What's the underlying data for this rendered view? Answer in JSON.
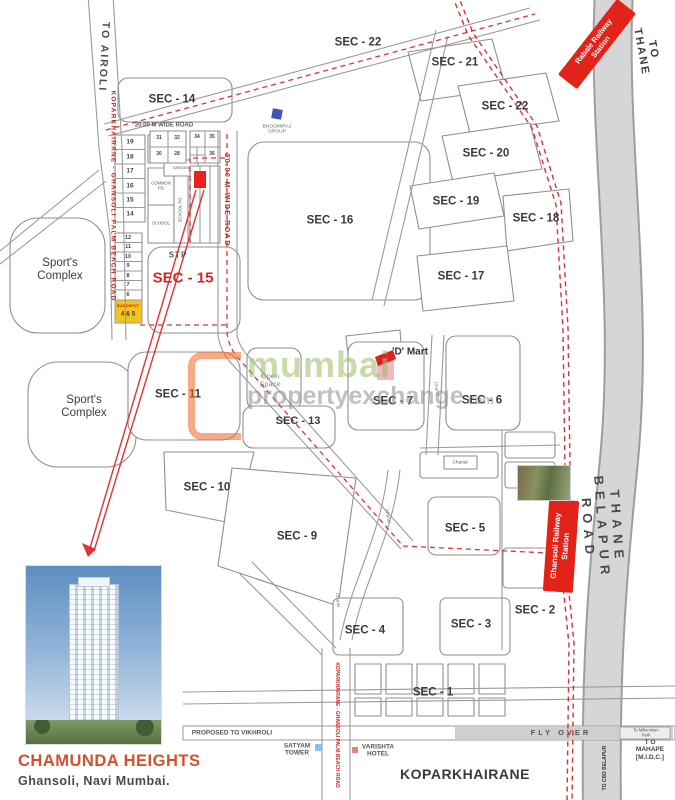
{
  "branding": {
    "project_name": "CHAMUNDA HEIGHTS",
    "project_location": "Ghansoli, Navi Mumbai."
  },
  "watermark": {
    "brand": "mumbai",
    "suffix": "propertyexchange",
    "tld": ".com"
  },
  "stations": {
    "rabale": "Rabale Railway\nStation",
    "ghansoli": "Ghansoli Railway\nStation"
  },
  "colors": {
    "station_red": "#e2231a",
    "route_dash_red": "#e03232",
    "road_label_red": "#cf1f1f",
    "sector_text": "#3a3a3a",
    "bus_depot_yellow": "#f2c51d",
    "watermark_green": "#9cbb66",
    "watermark_orange": "#f26522",
    "project_accent": "#d4502a",
    "bhoomiraj_blue": "#4053b8"
  },
  "map": {
    "labels": [
      {
        "id": "road-to-airoli",
        "text": "TO AIROLI",
        "x": 103,
        "y": 57,
        "rot": 93,
        "size": 10.5,
        "color": "#4a4a4a",
        "weight": 600,
        "ls": 2
      },
      {
        "id": "road-palm-beach-left",
        "text": "KOPARKHAIRANE - GHANSOLI PALM BEACH ROAD",
        "x": 113,
        "y": 196,
        "rot": 90,
        "size": 6.5,
        "color": "#cf1f1f",
        "ls": 1.2
      },
      {
        "id": "sector-14",
        "text": "SEC - 14",
        "x": 172,
        "y": 100
      },
      {
        "id": "road-20m-wide-top",
        "text": "20.00 M WIDE ROAD",
        "x": 164,
        "y": 126,
        "size": 6,
        "color": "#555",
        "weight": 600
      },
      {
        "id": "road-20m-wide-red",
        "text": "20.00 M WIDE ROAD",
        "x": 226,
        "y": 200,
        "rot": 90,
        "size": 7,
        "color": "#cf1f1f",
        "ls": 1.5
      },
      {
        "id": "sector-22-west",
        "text": "SEC - 22",
        "x": 358,
        "y": 43
      },
      {
        "id": "sector-21",
        "text": "SEC - 21",
        "x": 455,
        "y": 63
      },
      {
        "id": "sector-22-east",
        "text": "SEC - 22",
        "x": 505,
        "y": 107
      },
      {
        "id": "sector-20",
        "text": "SEC - 20",
        "x": 486,
        "y": 154
      },
      {
        "id": "sector-19",
        "text": "SEC - 19",
        "x": 456,
        "y": 202
      },
      {
        "id": "sector-18",
        "text": "SEC - 18",
        "x": 536,
        "y": 219
      },
      {
        "id": "sector-17",
        "text": "SEC - 17",
        "x": 461,
        "y": 277
      },
      {
        "id": "sector-16",
        "text": "SEC - 16",
        "x": 330,
        "y": 221
      },
      {
        "id": "sector-15",
        "text": "SEC - 15",
        "x": 183,
        "y": 279,
        "size": 15,
        "color": "#e01f1f"
      },
      {
        "id": "stp-label",
        "text": "STP",
        "x": 178,
        "y": 256,
        "size": 8,
        "color": "#555",
        "ls": 1
      },
      {
        "id": "sector-11",
        "text": "SEC - 11",
        "x": 178,
        "y": 395
      },
      {
        "id": "sector-13",
        "text": "SEC - 13",
        "x": 298,
        "y": 421,
        "size": 11
      },
      {
        "id": "sector-7",
        "text": "SEC - 7",
        "x": 393,
        "y": 402
      },
      {
        "id": "sector-6",
        "text": "SEC - 6",
        "x": 482,
        "y": 401
      },
      {
        "id": "sector-10",
        "text": "SEC - 10",
        "x": 207,
        "y": 488
      },
      {
        "id": "sector-9",
        "text": "SEC - 9",
        "x": 297,
        "y": 537
      },
      {
        "id": "sector-5",
        "text": "SEC - 5",
        "x": 465,
        "y": 529
      },
      {
        "id": "sector-4",
        "text": "SEC - 4",
        "x": 365,
        "y": 631
      },
      {
        "id": "sector-3",
        "text": "SEC - 3",
        "x": 471,
        "y": 625
      },
      {
        "id": "sector-2",
        "text": "SEC - 2",
        "x": 535,
        "y": 611
      },
      {
        "id": "sector-1",
        "text": "SEC - 1",
        "x": 433,
        "y": 693
      },
      {
        "id": "sports-complex-north",
        "text": "Sport's\nComplex",
        "x": 60,
        "y": 270,
        "size": 11.5,
        "weight": 400,
        "color": "#3d3d3d"
      },
      {
        "id": "sports-complex-south",
        "text": "Sport's\nComplex",
        "x": 84,
        "y": 407,
        "size": 11.5,
        "weight": 400,
        "color": "#3d3d3d"
      },
      {
        "id": "open-space-label",
        "text": "Open\nSpace",
        "x": 270,
        "y": 381,
        "size": 7.5,
        "weight": 400,
        "color": "#8a8a8a"
      },
      {
        "id": "dmart-label",
        "text": "'D' Mart",
        "x": 410,
        "y": 352,
        "size": 10,
        "weight": 600,
        "color": "#333"
      },
      {
        "id": "bhoomiraj-label",
        "text": "BHOOMIRAJ\nGROUP",
        "x": 277,
        "y": 130,
        "size": 4.8,
        "weight": 400,
        "color": "#666"
      },
      {
        "id": "road-to-thane",
        "text": "TO THANE",
        "x": 647,
        "y": 51,
        "rot": 80,
        "size": 11,
        "color": "#3f3f3f",
        "ls": 2
      },
      {
        "id": "road-thane-belapur",
        "text": "THANE BELAPUR ROAD",
        "x": 602,
        "y": 528,
        "rot": 86,
        "size": 13,
        "ls": 6,
        "color": "#4a4a4a"
      },
      {
        "id": "flyover-label",
        "text": "FLY OVER",
        "x": 561,
        "y": 733,
        "size": 7.5,
        "ls": 3,
        "color": "#555",
        "weight": 600
      },
      {
        "id": "road-proposed-vikhroli",
        "text": "PROPOSED TO VIKHROLI",
        "x": 232,
        "y": 733,
        "size": 6.5,
        "color": "#555",
        "weight": 600
      },
      {
        "id": "millennium-park-label",
        "text": "To Millennium Park",
        "x": 646,
        "y": 733,
        "size": 4.2,
        "weight": 400,
        "color": "#555"
      },
      {
        "id": "to-mahape-label",
        "text": "T O MAHAPE\n[M.I.D.C.]",
        "x": 650,
        "y": 750,
        "size": 6.5,
        "color": "#444",
        "weight": 600
      },
      {
        "id": "road-to-cbd-belapur",
        "text": "TO CBD BELAPUR",
        "x": 606,
        "y": 768,
        "rot": -90,
        "size": 5,
        "color": "#333",
        "weight": 600
      },
      {
        "id": "koparkhairane-label",
        "text": "KOPARKHAIRANE",
        "x": 465,
        "y": 775,
        "size": 14,
        "ls": 0.5
      },
      {
        "id": "road-palm-beach-bottom",
        "text": "KOPARKHAIRANE - GHANSOLI PALM BEACH ROAD",
        "x": 336,
        "y": 725,
        "rot": 90,
        "size": 5,
        "color": "#cf1f1f"
      },
      {
        "id": "satyam-tower-label",
        "text": "SATYAM\nTOWER",
        "x": 297,
        "y": 750,
        "size": 6.5,
        "color": "#555",
        "weight": 600
      },
      {
        "id": "varishta-hotel-label",
        "text": "VARISHTA\nHOTEL",
        "x": 378,
        "y": 751,
        "size": 6.5,
        "color": "#555",
        "weight": 600
      },
      {
        "id": "canal-label-1",
        "text": "Chanel",
        "x": 437,
        "y": 389,
        "rot": 80,
        "size": 4.5,
        "weight": 400,
        "color": "#777"
      },
      {
        "id": "canal-label-2",
        "text": "Chanel",
        "x": 388,
        "y": 516,
        "rot": 80,
        "size": 4.5,
        "weight": 400,
        "color": "#777"
      },
      {
        "id": "canal-label-3",
        "text": "Chanel",
        "x": 338,
        "y": 600,
        "rot": 85,
        "size": 4.5,
        "weight": 400,
        "color": "#777"
      },
      {
        "id": "canal-label-4",
        "text": "Chanal",
        "x": 460,
        "y": 463,
        "size": 4.8,
        "weight": 400,
        "color": "#555"
      },
      {
        "id": "plot-19",
        "text": "19",
        "x": 130,
        "y": 142,
        "size": 6.5,
        "color": "#444",
        "weight": 600
      },
      {
        "id": "plot-18",
        "text": "18",
        "x": 130,
        "y": 157,
        "size": 6.5,
        "color": "#444",
        "weight": 600
      },
      {
        "id": "plot-17",
        "text": "17",
        "x": 130,
        "y": 171,
        "size": 6.5,
        "color": "#444",
        "weight": 600
      },
      {
        "id": "plot-16",
        "text": "16",
        "x": 130,
        "y": 186,
        "size": 6.5,
        "color": "#444",
        "weight": 600
      },
      {
        "id": "plot-15",
        "text": "15",
        "x": 130,
        "y": 200,
        "size": 6.5,
        "color": "#444",
        "weight": 600
      },
      {
        "id": "plot-14",
        "text": "14",
        "x": 130,
        "y": 214,
        "size": 6.5,
        "color": "#444",
        "weight": 600
      },
      {
        "id": "plot-12",
        "text": "12",
        "x": 128,
        "y": 238,
        "size": 5.5,
        "color": "#444",
        "weight": 600
      },
      {
        "id": "plot-11",
        "text": "11",
        "x": 128,
        "y": 247,
        "size": 5.5,
        "color": "#444",
        "weight": 600
      },
      {
        "id": "plot-10",
        "text": "10",
        "x": 128,
        "y": 257,
        "size": 5.5,
        "color": "#444",
        "weight": 600
      },
      {
        "id": "plot-9",
        "text": "9",
        "x": 128,
        "y": 266,
        "size": 5.5,
        "color": "#444",
        "weight": 600
      },
      {
        "id": "plot-8",
        "text": "8",
        "x": 128,
        "y": 276,
        "size": 5.5,
        "color": "#444",
        "weight": 600
      },
      {
        "id": "plot-7",
        "text": "7",
        "x": 128,
        "y": 285,
        "size": 5.5,
        "color": "#444",
        "weight": 600
      },
      {
        "id": "plot-6",
        "text": "6",
        "x": 128,
        "y": 295,
        "size": 5.5,
        "color": "#444",
        "weight": 600
      },
      {
        "id": "plot-31",
        "text": "31",
        "x": 159,
        "y": 139,
        "size": 5,
        "color": "#444",
        "weight": 600
      },
      {
        "id": "plot-32",
        "text": "32",
        "x": 177,
        "y": 139,
        "size": 5,
        "color": "#444",
        "weight": 600
      },
      {
        "id": "plot-30",
        "text": "30",
        "x": 159,
        "y": 155,
        "size": 5,
        "color": "#444",
        "weight": 600
      },
      {
        "id": "plot-28",
        "text": "28",
        "x": 177,
        "y": 155,
        "size": 5,
        "color": "#444",
        "weight": 600
      },
      {
        "id": "plot-34",
        "text": "34",
        "x": 197,
        "y": 138,
        "size": 5,
        "color": "#444",
        "weight": 600
      },
      {
        "id": "plot-35",
        "text": "35",
        "x": 212,
        "y": 138,
        "size": 5,
        "color": "#444",
        "weight": 600
      },
      {
        "id": "plot-36",
        "text": "36",
        "x": 212,
        "y": 155,
        "size": 5,
        "color": "#444",
        "weight": 600
      },
      {
        "id": "common-pg-label",
        "text": "COMMON\nPG",
        "x": 161,
        "y": 186,
        "size": 4.2,
        "weight": 400,
        "color": "#555"
      },
      {
        "id": "garden-label",
        "text": "GARDEN",
        "x": 181,
        "y": 168,
        "size": 4,
        "weight": 400,
        "color": "#555"
      },
      {
        "id": "school-label",
        "text": "SCHOOL",
        "x": 161,
        "y": 224,
        "size": 4.2,
        "weight": 400,
        "color": "#555"
      },
      {
        "id": "school-pg-label",
        "text": "SCHOOL PG",
        "x": 181,
        "y": 210,
        "rot": -90,
        "size": 4.2,
        "weight": 400,
        "color": "#555"
      },
      {
        "id": "bus-depot-label",
        "text": "BUS DEPOT",
        "x": 128,
        "y": 306,
        "size": 3.8,
        "color": "#cf1f1f",
        "weight": 600
      },
      {
        "id": "plot-4-5",
        "text": "4 & 5",
        "x": 128,
        "y": 315,
        "size": 6,
        "color": "#333"
      }
    ]
  }
}
